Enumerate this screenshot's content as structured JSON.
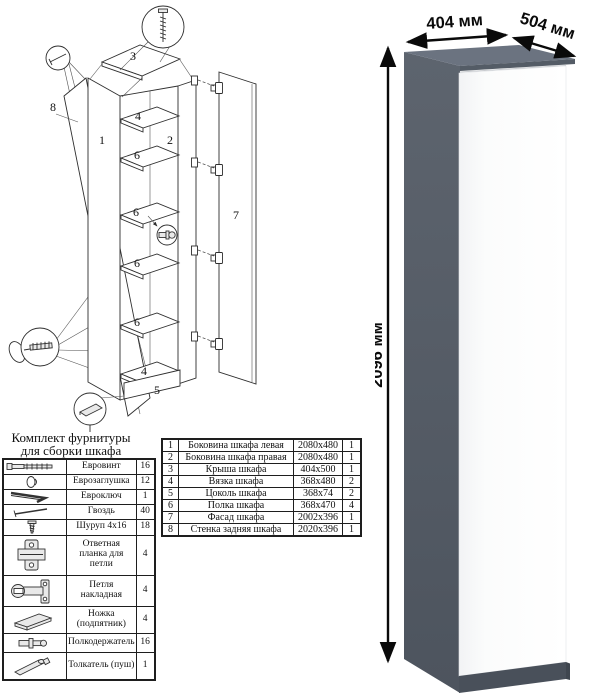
{
  "product": {
    "width_label": "404 мм",
    "depth_label": "504 мм",
    "height_label": "2096 мм",
    "colors": {
      "top": "#6b7380",
      "side": "#59606b",
      "door": "#fcfdfd",
      "plinth": "#49505a"
    }
  },
  "diagram": {
    "part_labels": [
      "8",
      "1",
      "3",
      "4",
      "2",
      "6",
      "6",
      "6",
      "6",
      "4",
      "5",
      "7"
    ],
    "callout_icons": [
      "confirmat-screw",
      "nail",
      "hex-key-with-screw",
      "adjustable-foot",
      "shelf-pin"
    ]
  },
  "hardware_kit": {
    "title_line1": "Комплект фурнитуры",
    "title_line2": "для сборки шкафа",
    "rows": [
      {
        "icon": "euro-screw-icon",
        "name": "Евровинт",
        "qty": "16"
      },
      {
        "icon": "euro-cap-icon",
        "name": "Еврозаглушка",
        "qty": "12"
      },
      {
        "icon": "hex-key-icon",
        "name": "Евроключ",
        "qty": "1"
      },
      {
        "icon": "nail-icon",
        "name": "Гвоздь",
        "qty": "40"
      },
      {
        "icon": "screw-icon",
        "name": "Шуруп 4x16",
        "qty": "18"
      },
      {
        "icon": "hinge-plate-icon",
        "name": "Ответная планка для петли",
        "qty": "4"
      },
      {
        "icon": "hinge-icon",
        "name": "Петля накладная",
        "qty": "4"
      },
      {
        "icon": "foot-icon",
        "name": "Ножка (подпятник)",
        "qty": "4"
      },
      {
        "icon": "shelf-pin-icon",
        "name": "Полкодержатель",
        "qty": "16"
      },
      {
        "icon": "push-rod-icon",
        "name": "Толкатель (пуш)",
        "qty": "1"
      }
    ]
  },
  "parts_table": {
    "rows": [
      {
        "num": "1",
        "name": "Боковина шкафа левая",
        "size": "2080x480",
        "qty": "1"
      },
      {
        "num": "2",
        "name": "Боковина шкафа правая",
        "size": "2080x480",
        "qty": "1"
      },
      {
        "num": "3",
        "name": "Крыша шкафа",
        "size": "404x500",
        "qty": "1"
      },
      {
        "num": "4",
        "name": "Вязка шкафа",
        "size": "368x480",
        "qty": "2"
      },
      {
        "num": "5",
        "name": "Цоколь шкафа",
        "size": "368x74",
        "qty": "2"
      },
      {
        "num": "6",
        "name": "Полка шкафа",
        "size": "368x470",
        "qty": "4"
      },
      {
        "num": "7",
        "name": "Фасад шкафа",
        "size": "2002x396",
        "qty": "1"
      },
      {
        "num": "8",
        "name": "Стенка задняя шкафа",
        "size": "2020x396",
        "qty": "1"
      }
    ]
  }
}
